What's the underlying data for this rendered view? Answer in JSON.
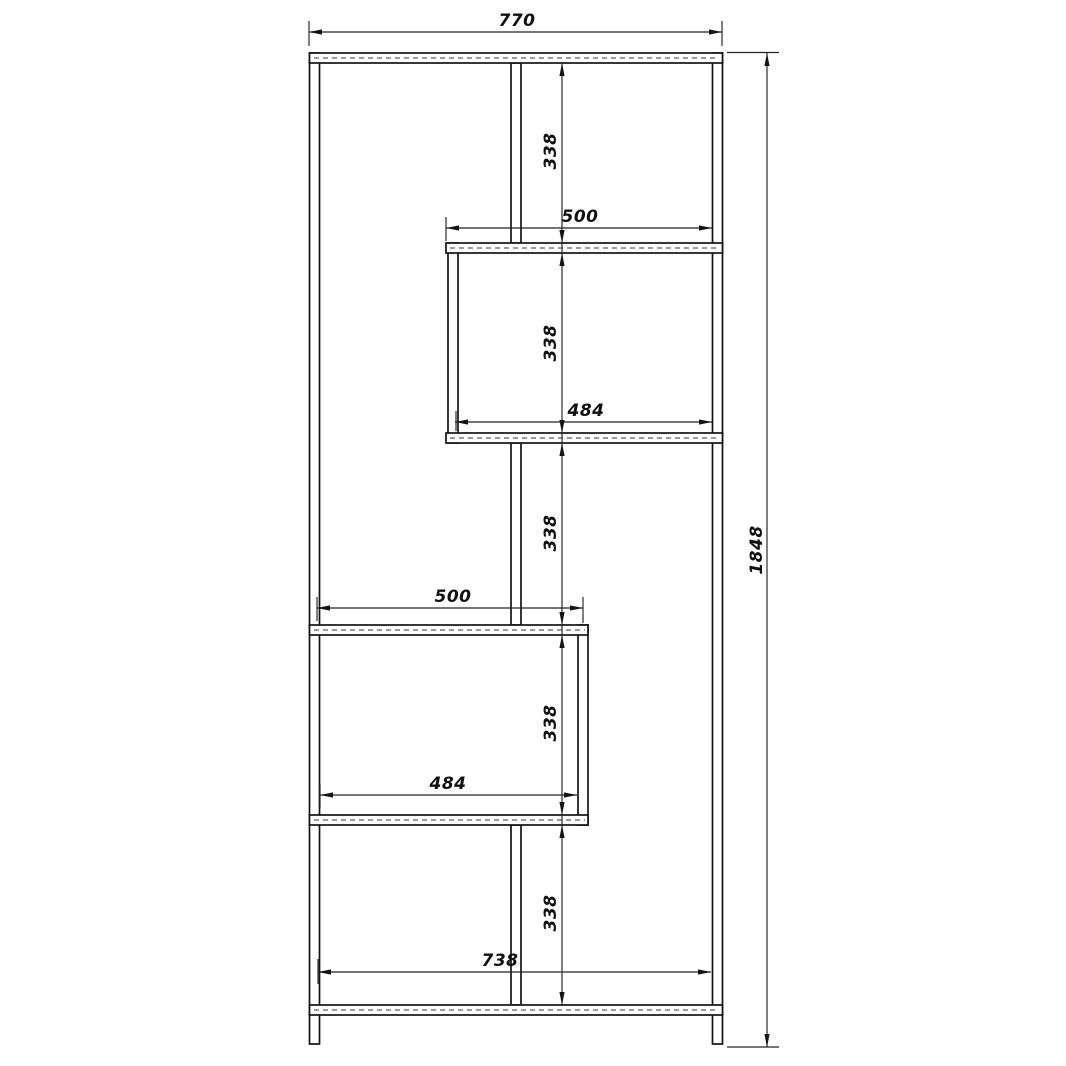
{
  "drawing": {
    "background_color": "#ffffff",
    "line_color": "#141414",
    "dimensions": {
      "overall_width": "770",
      "overall_height": "1848",
      "right_compartment_width": "500",
      "right_compartment_inner_width": "484",
      "left_compartment_width": "500",
      "left_compartment_inner_width": "484",
      "bottom_compartment_inner_width": "738",
      "compartment_heights": [
        "338",
        "338",
        "338",
        "338",
        "338"
      ]
    }
  }
}
